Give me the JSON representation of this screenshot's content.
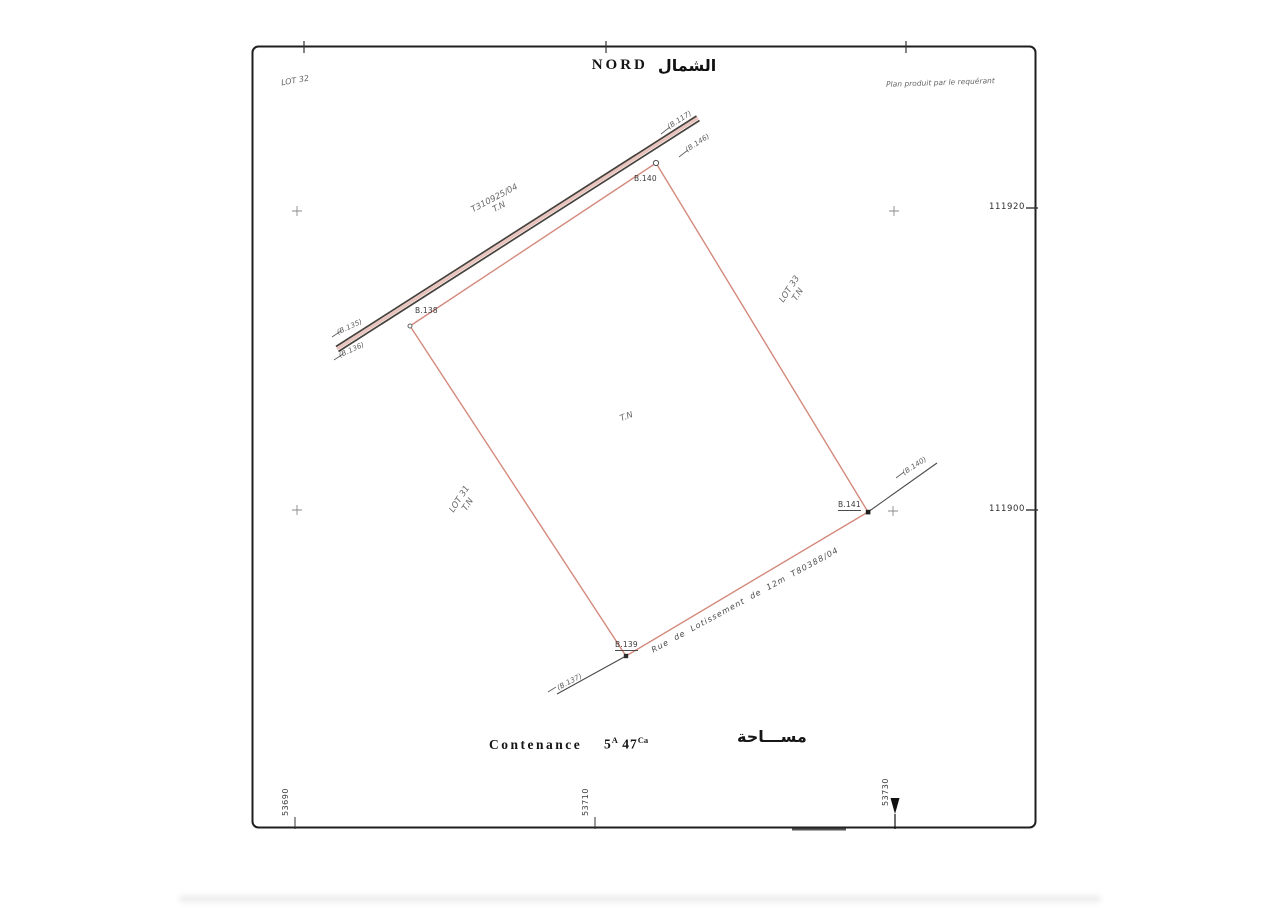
{
  "sheet": {
    "north_label": "NORD",
    "north_label_ar": "الشمال",
    "top_left_lot": "LOT 32",
    "producer_note": "Plan produit par le requérant"
  },
  "parcel": {
    "interior_label": "T.N",
    "vertices": {
      "top": "B.140",
      "left": "B.138",
      "bottom": "B.139",
      "right": "B.141"
    },
    "adjacent": {
      "road_title": "T310925/04",
      "road_title_sub": "T.N",
      "lot33": "LOT 33",
      "lot33_sub": "T.N",
      "lot31": "LOT 31",
      "lot31_sub": "T.N",
      "street": "Rue de Lotissement de 12m T80388/04"
    },
    "reference_points": {
      "top_outer": "(B.117)",
      "top_inner": "(B.146)",
      "left_outer": "(B.135)",
      "left_inner": "(B.136)",
      "bottom": "(B.137)",
      "right": "(B.140)"
    }
  },
  "grid": {
    "y_labels": [
      "111920",
      "111900"
    ],
    "x_labels": [
      "53690",
      "53710",
      "53730"
    ]
  },
  "area": {
    "label": "Contenance",
    "ares_value": "5",
    "ares_unit": "A",
    "centiares_value": "47",
    "centiares_unit": "Ca",
    "label_ar": "مســـاحة"
  },
  "colors": {
    "parcel_line": "#d4897c",
    "parcel_underlay": "#ddA398",
    "ink": "#2a2a2a",
    "road_ink": "#46413c",
    "grid_gray": "#8a8a8a"
  }
}
